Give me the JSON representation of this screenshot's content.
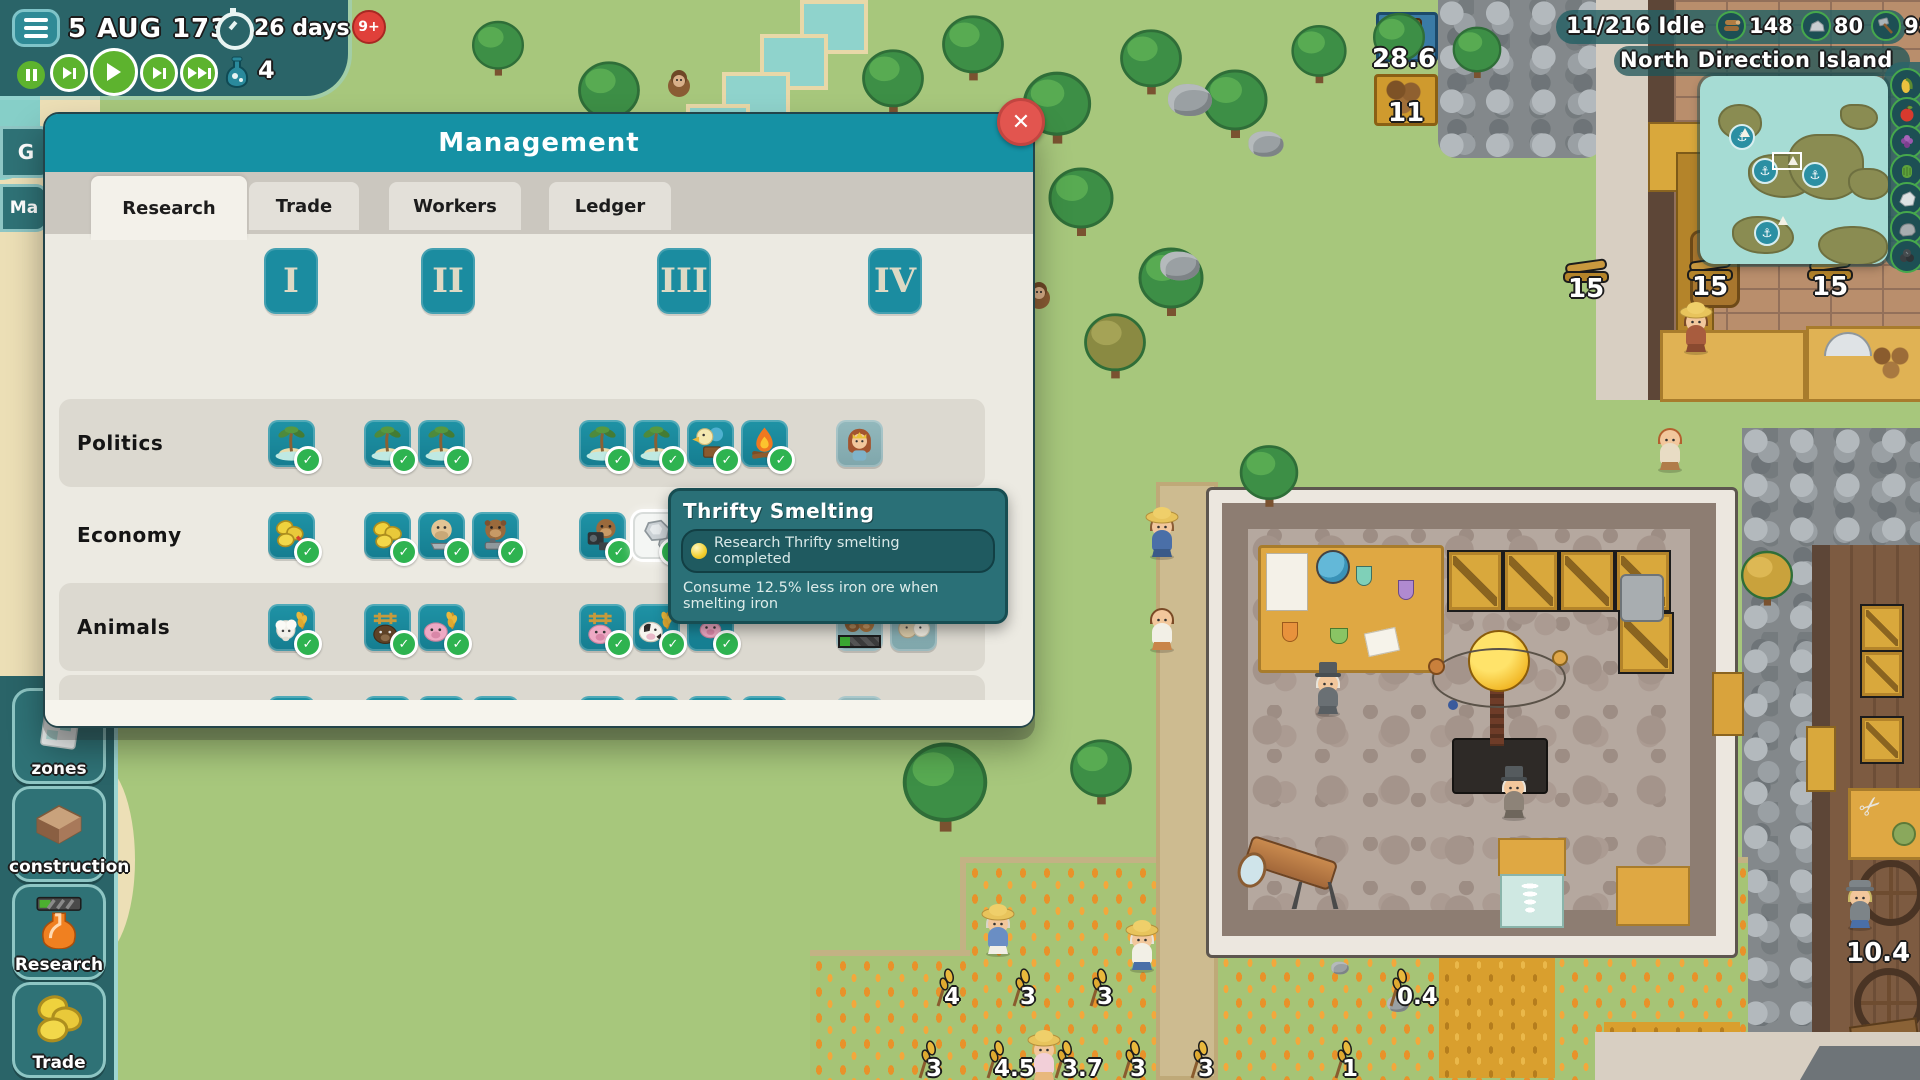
{
  "colors": {
    "accent_teal": "#1591a4",
    "hud_panel": "#2a6468",
    "check_green": "#2eb350",
    "close_red": "#e2554f",
    "locked_teal": "#8fb7bb"
  },
  "hud": {
    "menu_icon": "hamburger-icon",
    "date": "5 AUG 1733",
    "timer_label": "26 days",
    "notification_badge": "9+",
    "flask_count": "4",
    "playback": [
      {
        "id": "pause",
        "icon": "pause-icon"
      },
      {
        "id": "play-slow",
        "icon": "play-step-icon"
      },
      {
        "id": "play",
        "icon": "play-icon"
      },
      {
        "id": "fast",
        "icon": "fast-forward-icon"
      },
      {
        "id": "fastest",
        "icon": "fastest-icon"
      }
    ]
  },
  "top_right": {
    "idle": "11/216 Idle",
    "resources": [
      {
        "icon": "wood-icon",
        "value": "148"
      },
      {
        "icon": "stone-icon",
        "value": "80"
      },
      {
        "icon": "tools-icon",
        "value": "95"
      },
      {
        "icon": "bricks-icon",
        "value": "59"
      }
    ],
    "island_name": "North Direction Island"
  },
  "right_rail": {
    "icons": [
      "corn",
      "apple",
      "grapes",
      "greens",
      "marble",
      "boulder",
      "coal"
    ]
  },
  "left_edge_tabs": [
    {
      "label": "G"
    },
    {
      "label": "Ma"
    }
  ],
  "sidebar": {
    "buttons": [
      {
        "id": "zones",
        "label": "zones",
        "icon": "zones-map-icon"
      },
      {
        "id": "construction",
        "label": "construction",
        "icon": "foundation-icon"
      },
      {
        "id": "research",
        "label": "Research",
        "icon": "research-flask-icon"
      },
      {
        "id": "trade",
        "label": "Trade",
        "icon": "coins-icon"
      }
    ]
  },
  "dialog": {
    "title": "Management",
    "close_label": "✕",
    "tabs": [
      {
        "label": "Research",
        "active": true
      },
      {
        "label": "Trade",
        "active": false
      },
      {
        "label": "Workers",
        "active": false
      },
      {
        "label": "Ledger",
        "active": false
      }
    ],
    "tiers": [
      "I",
      "II",
      "III",
      "IV"
    ],
    "rows": [
      {
        "label": "Politics",
        "band": true,
        "items": [
          {
            "tier": 0,
            "slot": 0,
            "icon": "palm-island",
            "state": "done"
          },
          {
            "tier": 1,
            "slot": 0,
            "icon": "palm-island",
            "state": "done"
          },
          {
            "tier": 1,
            "slot": 1,
            "icon": "palm-island",
            "state": "done"
          },
          {
            "tier": 2,
            "slot": 0,
            "icon": "palm-island",
            "state": "done"
          },
          {
            "tier": 2,
            "slot": 1,
            "icon": "palm-island",
            "state": "done"
          },
          {
            "tier": 2,
            "slot": 2,
            "icon": "herald-horn",
            "state": "done"
          },
          {
            "tier": 2,
            "slot": 3,
            "icon": "campfire",
            "state": "done"
          },
          {
            "tier": 3,
            "slot": 0,
            "icon": "queen",
            "state": "locked"
          }
        ]
      },
      {
        "label": "Economy",
        "band": false,
        "items": [
          {
            "tier": 0,
            "slot": 0,
            "icon": "coins-tax",
            "state": "done"
          },
          {
            "tier": 1,
            "slot": 0,
            "icon": "coins",
            "state": "done"
          },
          {
            "tier": 1,
            "slot": 1,
            "icon": "walrus-saw",
            "state": "done"
          },
          {
            "tier": 1,
            "slot": 2,
            "icon": "beaver-plane",
            "state": "done"
          },
          {
            "tier": 2,
            "slot": 0,
            "icon": "beaver-camera",
            "state": "done"
          },
          {
            "tier": 2,
            "slot": 1,
            "icon": "iron-ore",
            "state": "highlight"
          },
          {
            "tier": 3,
            "slot": 0,
            "icon": "beaver-camera",
            "state": "locked"
          }
        ]
      },
      {
        "label": "Animals",
        "band": true,
        "items": [
          {
            "tier": 0,
            "slot": 0,
            "icon": "sheep-wheat",
            "state": "done"
          },
          {
            "tier": 1,
            "slot": 0,
            "icon": "boar-fence",
            "state": "done"
          },
          {
            "tier": 1,
            "slot": 1,
            "icon": "pig-wheat",
            "state": "done"
          },
          {
            "tier": 2,
            "slot": 0,
            "icon": "pig-fence",
            "state": "done"
          },
          {
            "tier": 2,
            "slot": 1,
            "icon": "cow-wheat",
            "state": "done"
          },
          {
            "tier": 2,
            "slot": 2,
            "icon": "piglet",
            "state": "done"
          },
          {
            "tier": 3,
            "slot": 0,
            "icon": "horse-pair",
            "state": "progress"
          },
          {
            "tier": 3,
            "slot": 1,
            "icon": "goat-pair",
            "state": "locked"
          }
        ]
      },
      {
        "label": "Construction",
        "band": true,
        "items": [
          {
            "tier": 0,
            "slot": 0,
            "icon": "stone-wall",
            "state": "done"
          },
          {
            "tier": 1,
            "slot": 0,
            "icon": "toolbench",
            "state": "done"
          },
          {
            "tier": 1,
            "slot": 1,
            "icon": "gear-axe",
            "state": "done"
          },
          {
            "tier": 1,
            "slot": 2,
            "icon": "gear-planks",
            "state": "done"
          },
          {
            "tier": 2,
            "slot": 0,
            "icon": "plank-wall",
            "state": "done"
          },
          {
            "tier": 2,
            "slot": 1,
            "icon": "scaffold",
            "state": "done"
          },
          {
            "tier": 2,
            "slot": 2,
            "icon": "gear-advanced",
            "state": "done"
          },
          {
            "tier": 2,
            "slot": 3,
            "icon": "sailboat",
            "state": "done"
          },
          {
            "tier": 3,
            "slot": 0,
            "icon": "ship-large",
            "state": "locked"
          }
        ]
      }
    ]
  },
  "tooltip": {
    "title": "Thrifty Smelting",
    "status": "Research Thrifty smelting completed",
    "description": "Consume 12.5% less iron ore when smelting iron"
  },
  "world": {
    "well_count": "28.6",
    "log_count": "11",
    "plank_counts": [
      "15",
      "15",
      "15"
    ],
    "monkey_count": "3",
    "wheat_row1": [
      "4",
      "3",
      "3",
      "0.4"
    ],
    "wheat_row2": [
      "3",
      "4.5",
      "3.7",
      "3",
      "3",
      "1"
    ],
    "tailor_count": "10.4"
  }
}
